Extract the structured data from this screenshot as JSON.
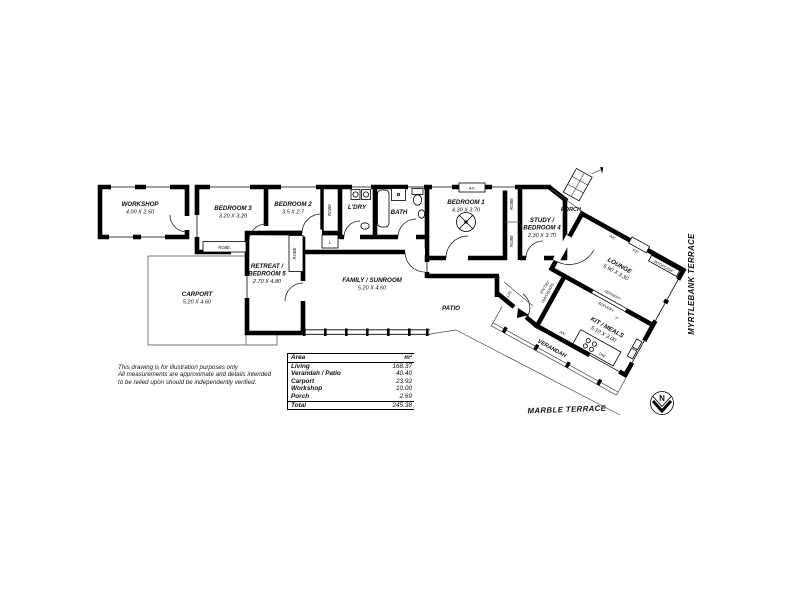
{
  "plan": {
    "rooms": {
      "workshop": {
        "name": "WORKSHOP",
        "dims": "4.00 X 2.50"
      },
      "carport": {
        "name": "CARPORT",
        "dims": "5.20 X 4.60"
      },
      "bedroom3": {
        "name": "BEDROOM 3",
        "dims": "3.20 X 3.20"
      },
      "bedroom2": {
        "name": "BEDROOM 2",
        "dims": "3.5 X 2.7"
      },
      "laundry": {
        "name": "L'DRY"
      },
      "bath": {
        "name": "BATH"
      },
      "bedroom1": {
        "name": "BEDROOM 1",
        "dims": "4.30 X 3.70"
      },
      "study": {
        "line1": "STUDY /",
        "line2": "BEDROOM 4",
        "dims": "2.30 X 3.70"
      },
      "retreat": {
        "line1": "RETREAT /",
        "line2": "BEDROOM 5",
        "dims": "2.70 X 4.80"
      },
      "family": {
        "name": "FAMILY / SUNROOM",
        "dims": "5.20 X 4.60"
      },
      "patio": {
        "name": "PATIO"
      },
      "porch": {
        "name": "PORCH"
      },
      "lounge": {
        "name": "LOUNGE",
        "dims": "5.90 X 3.30"
      },
      "kitchen": {
        "name": "KIT / MEALS",
        "dims": "5.10 X 3.00"
      },
      "verandah": {
        "name": "VERANDAH"
      }
    },
    "labels": {
      "robe": "ROBE",
      "linen_small": "L",
      "lin": "LIN",
      "entry": "ENTRY",
      "ac": "A/C",
      "fp": "F/P",
      "bookcase": "BOOKCASE",
      "servery": "SERVERY",
      "sideboard": "SIDEBOARD",
      "fridge": "F",
      "dw": "DW",
      "north": "N"
    },
    "streets": {
      "side": "MYRTLEBANK TERRACE",
      "bottom": "MARBLE TERRACE"
    },
    "disclaimer": {
      "line1": "This drawing is for illustration purposes only",
      "line2": "All measurements are approximate and details intended",
      "line3": "to be relied upon should be independently verified."
    },
    "area_table": {
      "header": {
        "label": "Area",
        "value": "m²"
      },
      "rows": [
        {
          "label": "Living",
          "value": "168.37"
        },
        {
          "label": "Verandah / Patio",
          "value": "40.40"
        },
        {
          "label": "Carport",
          "value": "23.92"
        },
        {
          "label": "Workshop",
          "value": "10.00"
        },
        {
          "label": "Porch",
          "value": "2.69"
        }
      ],
      "total": {
        "label": "Total",
        "value": "245.38"
      }
    }
  }
}
